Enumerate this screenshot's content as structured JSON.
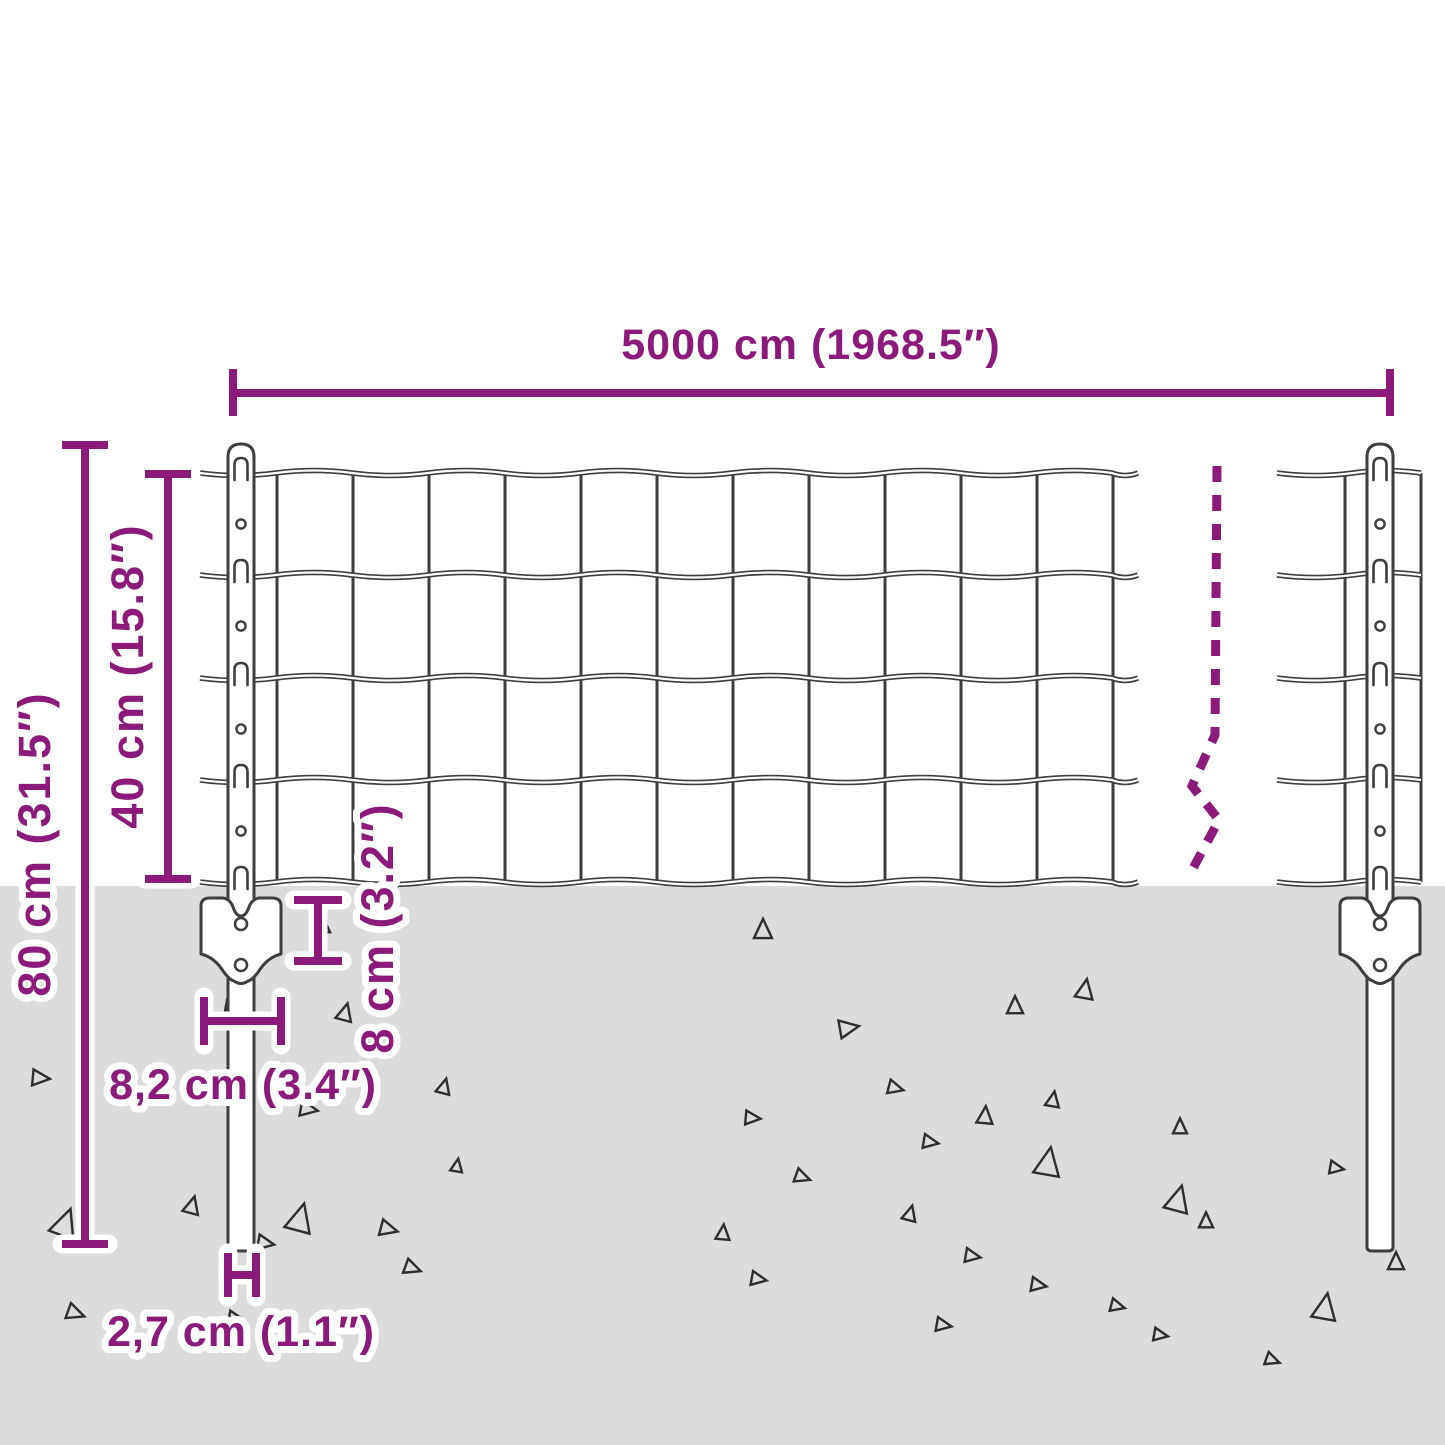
{
  "title": "Fence panel dimension diagram",
  "colors": {
    "accent": "#8b1a7b",
    "ground": "#dcdcdc",
    "wire": "#3e3e3e",
    "background": "#ffffff"
  },
  "dimensions": {
    "total_length": "5000 cm (1968.5″)",
    "post_height": "80 cm (31.5″)",
    "mesh_height": "40 cm (15.8″)",
    "anchor_depth": "8 cm (3.2″)",
    "anchor_width": "8,2 cm (3.4″)",
    "post_diameter": "2,7 cm (1.1″)"
  },
  "decor": {
    "triangles": [
      [
        322,
        925,
        16,
        0
      ],
      [
        763,
        930,
        18,
        0
      ],
      [
        232,
        1008,
        14,
        100
      ],
      [
        345,
        1013,
        16,
        15
      ],
      [
        1085,
        990,
        18,
        10
      ],
      [
        1015,
        1006,
        16,
        0
      ],
      [
        848,
        1028,
        18,
        80
      ],
      [
        40,
        1078,
        16,
        95
      ],
      [
        444,
        1087,
        14,
        15
      ],
      [
        308,
        1109,
        16,
        100
      ],
      [
        895,
        1088,
        14,
        105
      ],
      [
        1053,
        1100,
        14,
        10
      ],
      [
        985,
        1116,
        16,
        5
      ],
      [
        752,
        1118,
        14,
        95
      ],
      [
        1180,
        1127,
        14,
        0
      ],
      [
        930,
        1142,
        14,
        100
      ],
      [
        457,
        1166,
        12,
        10
      ],
      [
        1048,
        1163,
        26,
        10
      ],
      [
        802,
        1177,
        14,
        110
      ],
      [
        192,
        1206,
        16,
        15
      ],
      [
        65,
        1224,
        26,
        20
      ],
      [
        300,
        1219,
        26,
        15
      ],
      [
        388,
        1229,
        16,
        105
      ],
      [
        910,
        1214,
        14,
        15
      ],
      [
        723,
        1233,
        14,
        5
      ],
      [
        1206,
        1221,
        14,
        0
      ],
      [
        972,
        1256,
        14,
        100
      ],
      [
        1178,
        1200,
        24,
        15
      ],
      [
        1336,
        1168,
        13,
        100
      ],
      [
        1396,
        1262,
        16,
        0
      ],
      [
        265,
        1243,
        15,
        100
      ],
      [
        412,
        1268,
        15,
        110
      ],
      [
        758,
        1279,
        14,
        100
      ],
      [
        1038,
        1285,
        14,
        100
      ],
      [
        75,
        1313,
        16,
        110
      ],
      [
        235,
        1318,
        13,
        100
      ],
      [
        1117,
        1306,
        13,
        105
      ],
      [
        943,
        1325,
        14,
        100
      ],
      [
        1325,
        1308,
        24,
        10
      ],
      [
        1160,
        1335,
        13,
        100
      ],
      [
        1272,
        1360,
        13,
        110
      ]
    ]
  }
}
